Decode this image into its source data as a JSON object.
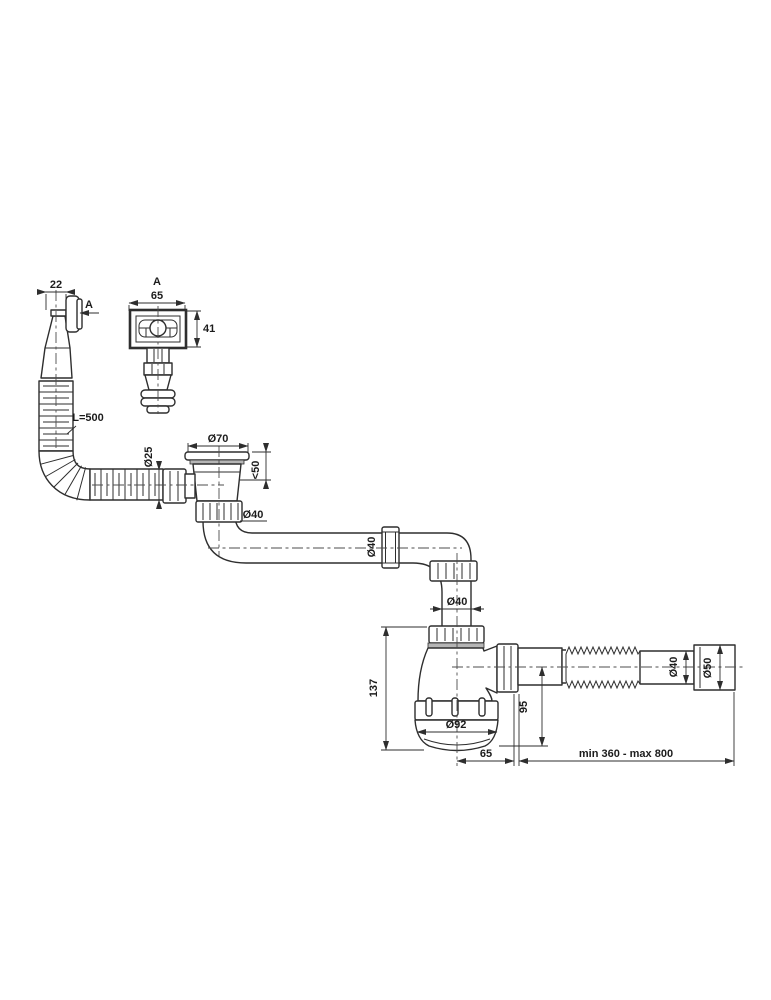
{
  "colors": {
    "background": "#ffffff",
    "line": "#2e2e2e",
    "text": "#1c1c1c"
  },
  "labels": {
    "side_width": "22",
    "view_marker": "A",
    "section_label": "A",
    "face_width": "65",
    "face_height": "41",
    "hose_length": "L=500",
    "hose_dia": "Ø25",
    "flange_dia": "Ø70",
    "mount_depth": "<50",
    "strainer_outlet_dia": "Ø40",
    "pipe_nut_dia": "Ø40",
    "trap_inlet_dia": "Ø40",
    "trap_height": "137",
    "cup_dia": "Ø92",
    "outlet_drop": "95",
    "outlet_offset": "65",
    "flex_small_dia": "Ø40",
    "flex_large_dia": "Ø50",
    "flex_range": "min 360 - max 800"
  }
}
